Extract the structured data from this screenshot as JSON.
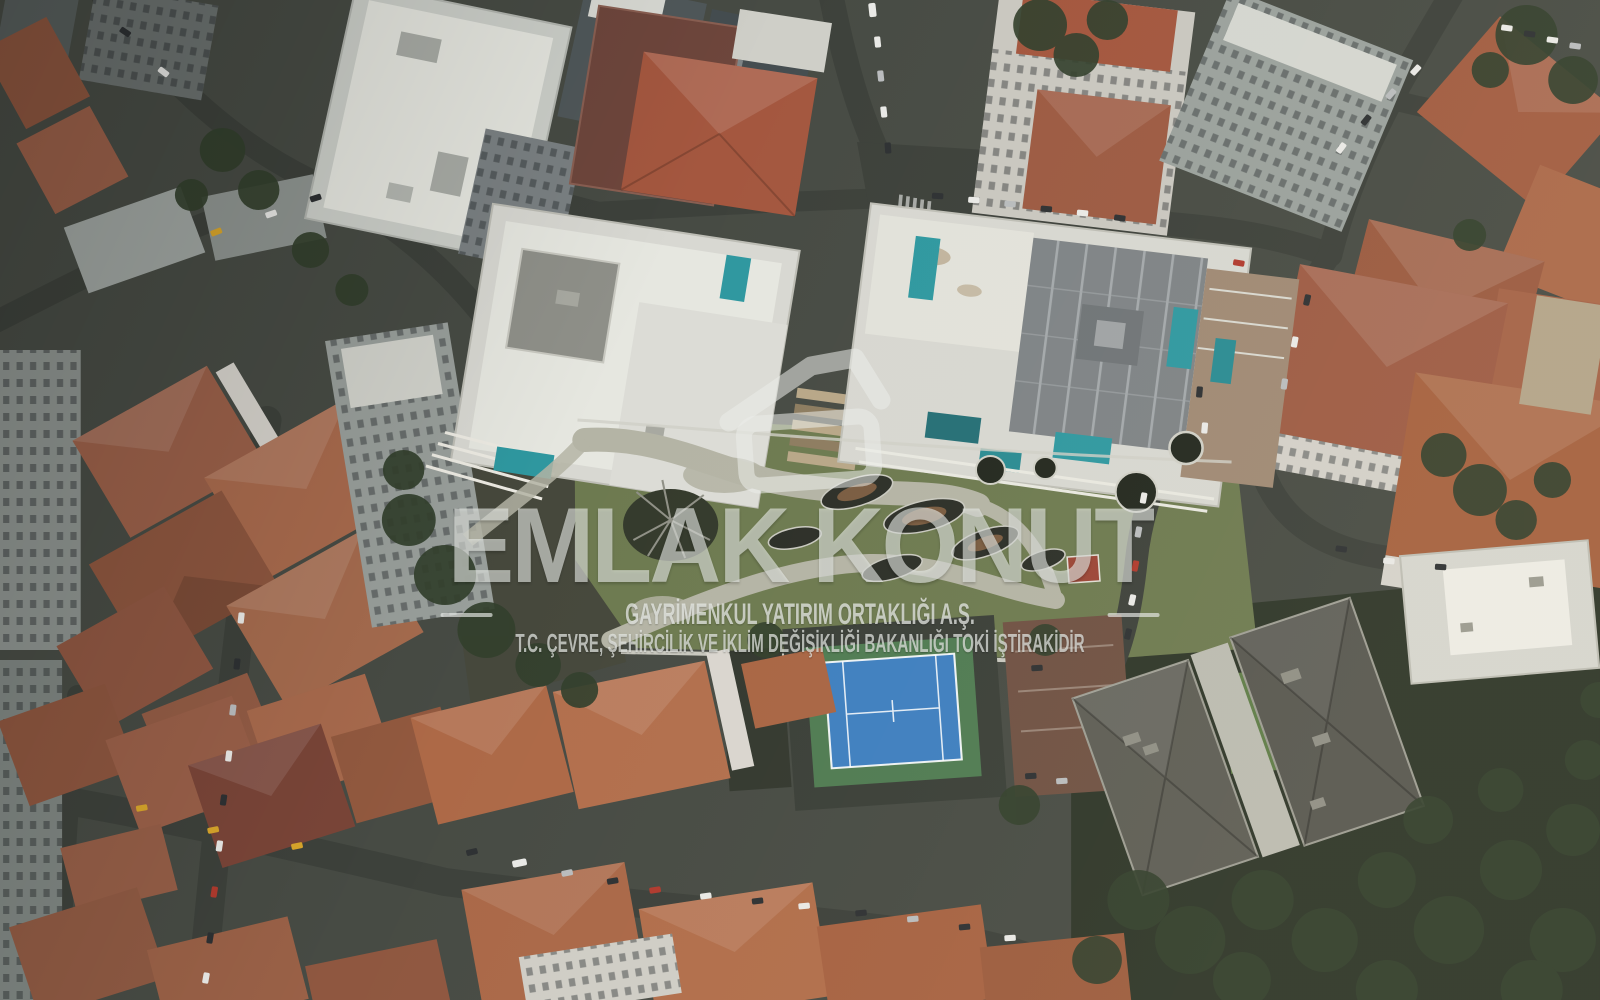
{
  "watermark": {
    "logo_icon": "emlak-konut-house-logo",
    "title": "EMLAK KONUT",
    "subtitle": "GAYRİMENKUL YATIRIM ORTAKLIĞI A.Ş.",
    "disclaimer": "T.C. ÇEVRE, ŞEHİRCİLİK VE İKLİM DEĞİŞİKLİĞİ BAKANLIĞI TOKİ İŞTİRAKİDİR"
  },
  "scene": {
    "type": "aerial-drone-photograph",
    "description": "Top-down daytime aerial view of a dense residential district: terracotta-roofed apartment blocks, a modern luxury housing complex with rooftop terraces and turquoise pools, a landscaped central garden with curved pale paths and leaf-shaped planters, a blue tennis court, tree-lined streets with parked cars and a large dark-roofed building among trees at lower right.",
    "landmarks": [
      "terracotta-roof-city-blocks",
      "modern-complex-with-pools",
      "central-landscaped-garden",
      "blue-tennis-court",
      "streets-with-parked-cars",
      "dark-roofed-building-in-trees"
    ]
  },
  "palette": {
    "asphalt": "#474b44",
    "road": "#3d413b",
    "roof_red_1": "#9a6049",
    "roof_red_2": "#a86a4d",
    "roof_red_3": "#8d563f",
    "roof_orange": "#b26f4d",
    "roof_maroon": "#7a4538",
    "facade_light": "#cfd2cb",
    "facade_gray": "#969c98",
    "roof_white": "#d8d8d2",
    "roof_bright": "#e6e7e0",
    "panel_gray": "#7e8386",
    "terrace_tan": "#9f8974",
    "pool_teal": "#2f98a0",
    "lawn": "#6d7a50",
    "park_path": "#b4b4a5",
    "foliage_dark": "#33402d",
    "planter_dark": "#2c2f28",
    "planter_soil": "#7a5c41",
    "court_blue": "#3e7fc0",
    "court_green": "#4f7b52",
    "car_white": "#e9e9e6",
    "car_dark": "#2e3133",
    "car_silver": "#b9bcbe",
    "car_red": "#b03a2e",
    "car_yellow": "#d9a62b",
    "watermark": "rgba(233,235,231,0.62)"
  }
}
